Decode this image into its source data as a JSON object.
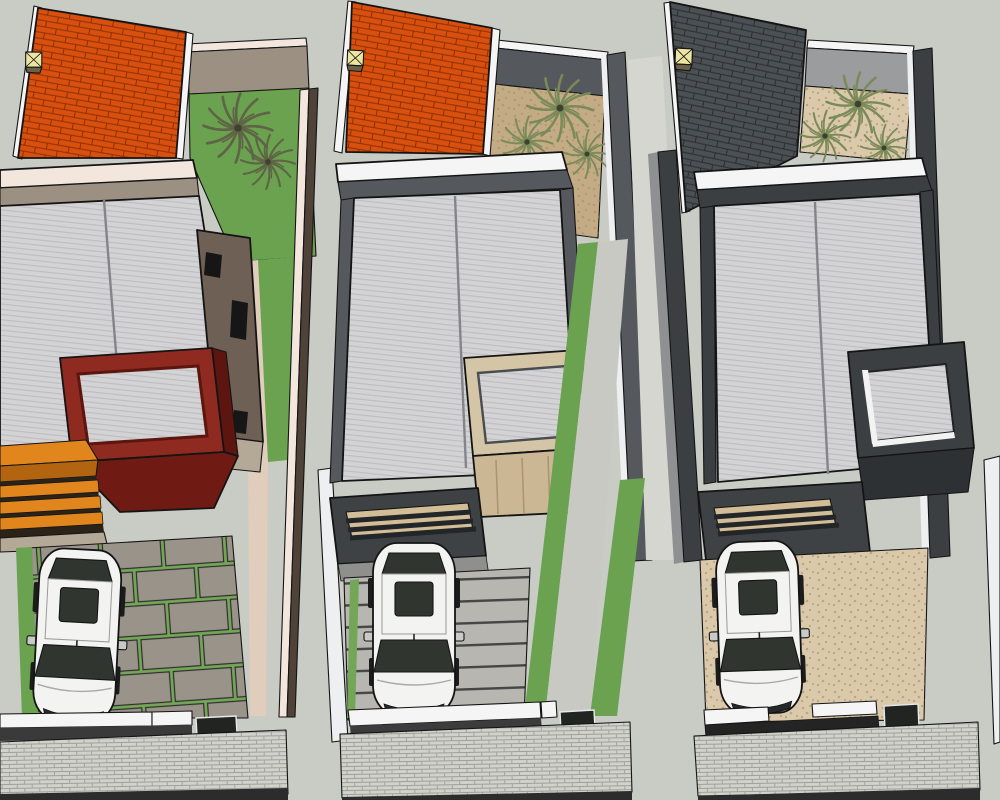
{
  "scene": {
    "kind": "aerial 3d architectural model render",
    "style": "sketchup",
    "plots": [
      {
        "position": "left",
        "roof_tiles": "orange clay",
        "accent_volume": "maroon red balcony frame",
        "pergola": "orange wood slats",
        "garden": "green lawn with two palms",
        "driveway": "grey stone slabs with grass joints",
        "cars": 1,
        "skylights": 1
      },
      {
        "position": "middle",
        "roof_tiles": "orange clay",
        "accent_volume": "tan wood balcony frame",
        "garden": "sand gravel court with three palms",
        "driveway": "striped concrete with lawn strips",
        "cars": 1,
        "skylights": 1
      },
      {
        "position": "right",
        "roof_tiles": "dark grey",
        "accent_volume": "charcoal balcony frame",
        "garden": "sand gravel court with three palms",
        "driveway": "plain sand paving",
        "cars": 1,
        "skylights": 1
      }
    ]
  },
  "palette": {
    "background": "#c9cbc5",
    "road": "#2b2c2b",
    "sidewalk": "#d2d2cc",
    "sidewalk-line": "#9fa09b",
    "tile-orange": "#d9500e",
    "tile-orange-line": "#8a2f05",
    "tile-dark": "#4b5054",
    "tile-dark-line": "#2a2d30",
    "skylight": "#ece5a1",
    "skylight-base": "#6b6147",
    "roof": "#d3d3d5",
    "roof-line": "#bdbdc0",
    "ridge": "#84858a",
    "fascia-pink": "#f3e6dd",
    "fascia-white": "#f4f5f4",
    "wall-taupe": "#9c9083",
    "wall-brown": "#4f4238",
    "house-brown": "#6e6055",
    "wall-dark": "#55585c",
    "wall-charcoal": "#3c3f42",
    "wall-light": "#9b9c9e",
    "grass": "#6ba24f",
    "grass-joint": "#74a658",
    "palm-olive": "#5f6347",
    "palm-green": "#7a8a58",
    "palm-core": "#3f4030",
    "gravel": "#c3ab85",
    "gravel-light": "#dac9ab",
    "gravel-dot": "#a98e63",
    "maroon": "#8e2a20",
    "maroon-dark": "#5c150f",
    "maroon-deep": "#6f1b14",
    "wood": "#e1861c",
    "wood-dark": "#b26410",
    "wood-gap": "#2c2318",
    "box-tan": "#d5c5a7",
    "box-tan-face": "#cbb794",
    "box-tan-streak": "#ab9671",
    "canopy": "#3f4245",
    "canopy-tan": "#d3bd97",
    "slat": "#232629",
    "drive-slab": "#9a938a",
    "drive-concrete": "#b8b6b1",
    "drive-stripe": "#454543",
    "alley": "#d6d6d0",
    "path-tan": "#e0cdbb",
    "car-body": "#f3f3f2",
    "car-shade": "#c9c9c7",
    "car-glass": "#30362f",
    "gate-dark": "#222422",
    "white-wall": "#edeff0",
    "porch": "#b4a896"
  }
}
